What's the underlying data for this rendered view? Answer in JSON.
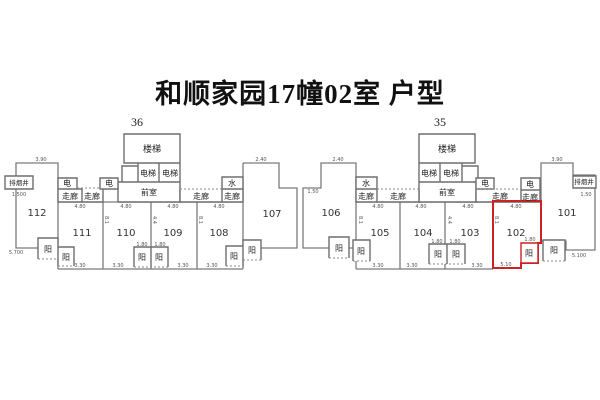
{
  "title": "和顺家园17幢02室 户型",
  "block_left": {
    "label": "36"
  },
  "block_right": {
    "label": "35"
  },
  "rooms": {
    "stairs": "楼梯",
    "elevator": "电梯",
    "vestibule": "前室",
    "corridor": "走廊",
    "electric": "电",
    "water": "水",
    "smoke_shaft": "排烟井",
    "balcony": "阳"
  },
  "units": [
    "112",
    "111",
    "110",
    "109",
    "108",
    "107",
    "106",
    "105",
    "104",
    "103",
    "102",
    "101"
  ],
  "highlight": {
    "unit": "102",
    "color": "#cc2222"
  },
  "dims": {
    "unit_top": "4.80",
    "unit_bottom": "3.30",
    "unit_bottom_wide": "5.10",
    "balcony": "1.80",
    "end_top": "3.90",
    "mid_top": "2.40",
    "notch": "1.50",
    "shaft": "1.500",
    "left_end": "5.700",
    "right_end": "5.100",
    "depth": "8.1",
    "depth_half": "4.4"
  }
}
